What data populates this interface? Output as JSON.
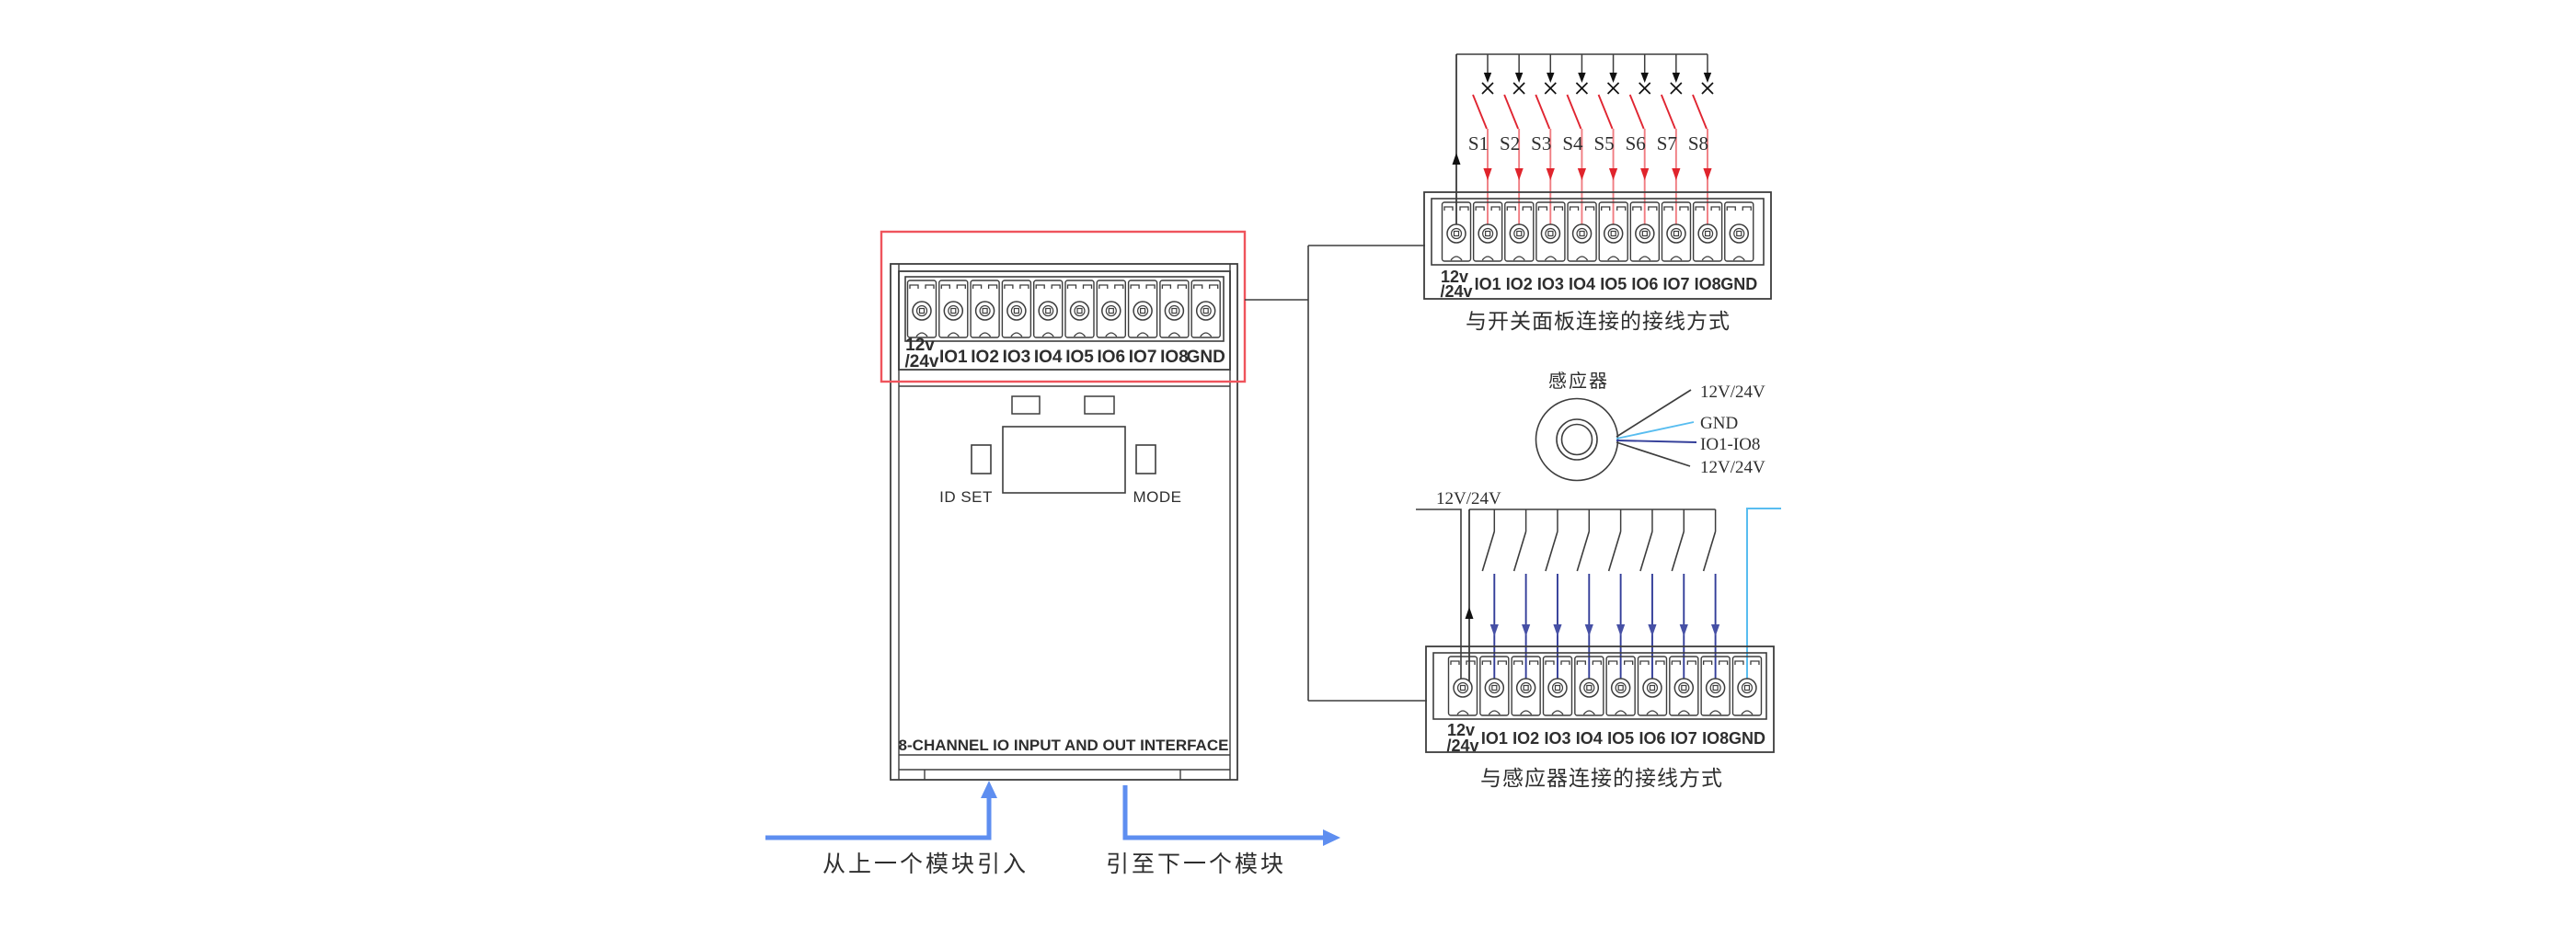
{
  "module": {
    "interface_label": "8-CHANNEL IO INPUT AND OUT INTERFACE",
    "id_set_label": "ID SET",
    "mode_label": "MODE"
  },
  "terminal_strip": {
    "power_line1": "12v",
    "power_line2": "/24v",
    "channels": [
      "IO1",
      "IO2",
      "IO3",
      "IO4",
      "IO5",
      "IO6",
      "IO7",
      "IO8"
    ],
    "ground": "GND"
  },
  "switch_panel_diagram": {
    "caption": "与开关面板连接的接线方式",
    "switches": [
      "S1",
      "S2",
      "S3",
      "S4",
      "S5",
      "S6",
      "S7",
      "S8"
    ]
  },
  "sensor": {
    "label": "感应器",
    "wires": [
      {
        "label": "12V/24V",
        "color": "#3d3d3d"
      },
      {
        "label": "GND",
        "color": "#58bdf0"
      },
      {
        "label": "IO1-IO8",
        "color": "#333e99"
      },
      {
        "label": "12V/24V",
        "color": "#3d3d3d"
      }
    ]
  },
  "sensor_wiring_diagram": {
    "caption": "与感应器连接的接线方式",
    "supply_label": "12V/24V"
  },
  "flow": {
    "from_previous": "从上一个模块引入",
    "to_next": "引至下一个模块"
  },
  "colors": {
    "outline": "#3d3d3d",
    "highlight_red": "#ef545c",
    "switch_red": "#e02531",
    "wire_red": "#f07d82",
    "red_arrow": "#e0242c",
    "wire_navy": "#333e99",
    "navy_arrow": "#4650a5",
    "wire_cyan": "#58bdf0",
    "flow_blue": "#5e8ef0"
  }
}
